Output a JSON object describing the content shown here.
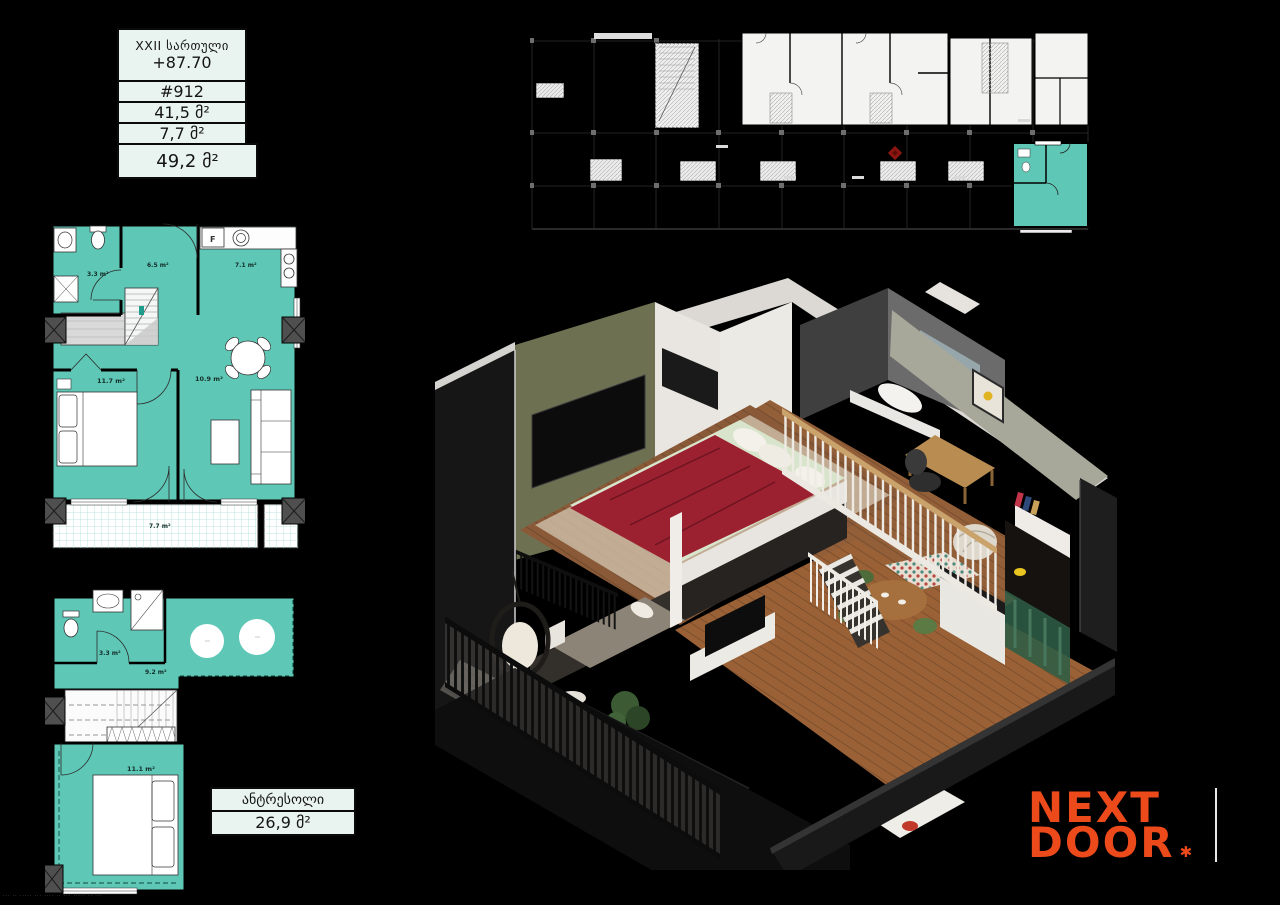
{
  "info_table": {
    "floor_label": "XXII სართული",
    "elevation": "+87.70",
    "unit_number": "#912",
    "area_living": "41,5 მ²",
    "area_balcony": "7,7 მ²",
    "area_total": "49,2 მ²"
  },
  "plan_upper": {
    "bathroom": "3.3 m²",
    "hall": "6.5 m²",
    "kitchen": "7.1 m²",
    "bedroom": "11.7 m²",
    "living": "10.9 m²",
    "balcony": "7.7 m²",
    "fridge": "F"
  },
  "plan_mezzanine": {
    "bathroom": "3.3 m²",
    "open_space": "9.2 m²",
    "bedroom": "11.1 m²"
  },
  "mezzanine_label": {
    "title": "ანტრესოლი",
    "area": "26,9 მ²"
  },
  "logo": {
    "line1": "NEXT",
    "line2": "DOOR",
    "mark": "✱"
  },
  "colors": {
    "unit_highlight": "#5FC7B6",
    "logo_orange": "#ED4A1C",
    "table_bg": "#E9F4F1",
    "north_marker": "#8B150F"
  },
  "watermark": "··· ·· ····· ··· ···· ·· ··· ····· ·· ···"
}
